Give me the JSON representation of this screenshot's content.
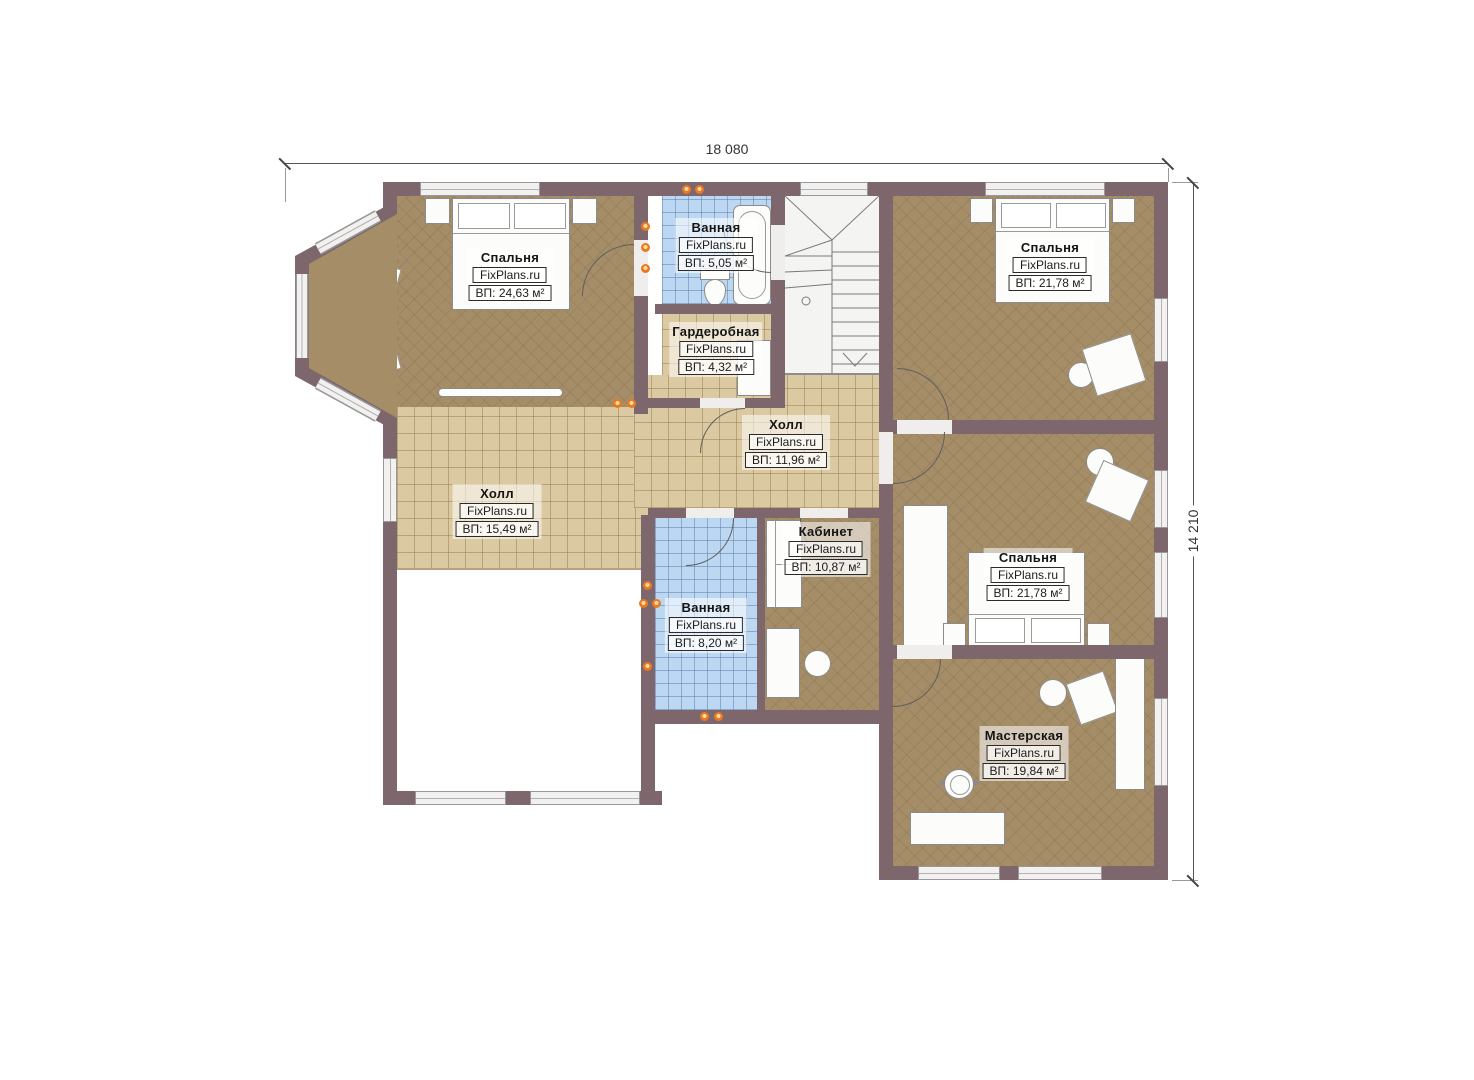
{
  "title": "Floor plan",
  "dimensions": {
    "width": "18 080",
    "height": "14 210"
  },
  "colors": {
    "wall": "#7d676d",
    "bedroom_floor": "#a48d67",
    "hall_floor": "#dbc9a1",
    "bath_floor": "#bcd7f1",
    "socket_accent": "#e87a22"
  },
  "rooms": [
    {
      "id": "bedroom-top-left",
      "name": "Спальня",
      "watermark": "FixPlans.ru",
      "area": "ВП: 24,63 м²"
    },
    {
      "id": "bathroom-top",
      "name": "Ванная",
      "watermark": "FixPlans.ru",
      "area": "ВП: 5,05 м²"
    },
    {
      "id": "wardrobe",
      "name": "Гардеробная",
      "watermark": "FixPlans.ru",
      "area": "ВП: 4,32 м²"
    },
    {
      "id": "bedroom-top-right",
      "name": "Спальня",
      "watermark": "FixPlans.ru",
      "area": "ВП: 21,78 м²"
    },
    {
      "id": "hall-center",
      "name": "Холл",
      "watermark": "FixPlans.ru",
      "area": "ВП: 11,96 м²"
    },
    {
      "id": "hall-left",
      "name": "Холл",
      "watermark": "FixPlans.ru",
      "area": "ВП: 15,49 м²"
    },
    {
      "id": "bathroom-middle",
      "name": "Ванная",
      "watermark": "FixPlans.ru",
      "area": "ВП: 8,20 м²"
    },
    {
      "id": "office",
      "name": "Кабинет",
      "watermark": "FixPlans.ru",
      "area": "ВП: 10,87 м²"
    },
    {
      "id": "bedroom-mid-right",
      "name": "Спальня",
      "watermark": "FixPlans.ru",
      "area": "ВП: 21,78 м²"
    },
    {
      "id": "workshop",
      "name": "Мастерская",
      "watermark": "FixPlans.ru",
      "area": "ВП: 19,84 м²"
    }
  ]
}
